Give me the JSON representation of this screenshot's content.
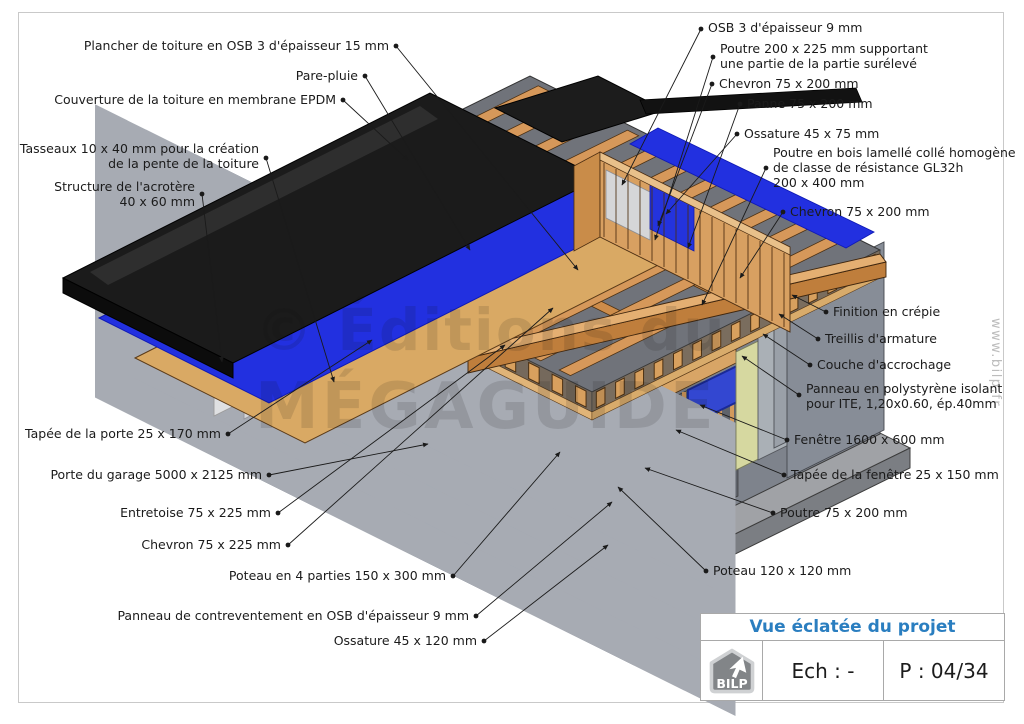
{
  "title_block": {
    "title": "Vue éclatée du projet",
    "scale_label": "Ech : -",
    "page_label": "P : 04/34",
    "logo_text": "BILP"
  },
  "watermark": {
    "center_line1": "© Éditions du",
    "center_line2": "MÉGAGUIDE",
    "side": "www.bilp.fr"
  },
  "labels": {
    "left": [
      {
        "text": "Plancher de toiture en OSB 3 d'épaisseur 15 mm"
      },
      {
        "text": "Pare-pluie"
      },
      {
        "text": "Couverture de la toiture en membrane EPDM"
      },
      {
        "text": "Tasseaux 10 x 40 mm pour la création\nde la pente de la toiture"
      },
      {
        "text": "Structure de l'acrotère\n40 x 60 mm"
      },
      {
        "text": "Tapée de la porte 25 x 170 mm"
      },
      {
        "text": "Porte du garage 5000 x 2125 mm"
      },
      {
        "text": "Entretoise 75 x 225 mm"
      },
      {
        "text": "Chevron 75 x 225 mm"
      },
      {
        "text": "Poteau en 4 parties 150 x 300 mm"
      },
      {
        "text": "Panneau de contreventement en OSB d'épaisseur 9 mm"
      },
      {
        "text": "Ossature 45 x 120 mm"
      }
    ],
    "right": [
      {
        "text": "OSB 3 d'épaisseur 9 mm"
      },
      {
        "text": "Poutre 200 x 225 mm supportant\nune partie de la partie surélevé"
      },
      {
        "text": "Chevron 75 x 200 mm"
      },
      {
        "text": "Panne 75 x 200 mm"
      },
      {
        "text": "Ossature 45 x 75 mm"
      },
      {
        "text": "Poutre en bois lamellé collé homogène\nde classe de résistance GL32h\n200 x 400 mm"
      },
      {
        "text": "Chevron 75 x 200 mm"
      },
      {
        "text": "Finition en crépie"
      },
      {
        "text": "Treillis d'armature"
      },
      {
        "text": "Couche d'accrochage"
      },
      {
        "text": "Panneau en polystyrène isolant\npour ITE, 1,20x0.60, ép.40mm"
      },
      {
        "text": "Fenêtre 1600 x 600 mm"
      },
      {
        "text": "Tapée de la fenêtre 25 x 150 mm"
      },
      {
        "text": "Poutre 75 x 200 mm"
      },
      {
        "text": "Poteau 120 x 120 mm"
      }
    ]
  },
  "colors": {
    "membrane_black": "#1b1b1b",
    "pare_pluie_blue": "#2230e0",
    "wood": "#d8a061",
    "osb_tan": "#ddb170",
    "concrete_gray": "#9fa1a6",
    "insulation_panel": "#d6d8a0",
    "title_blue": "#2a7ec0"
  }
}
